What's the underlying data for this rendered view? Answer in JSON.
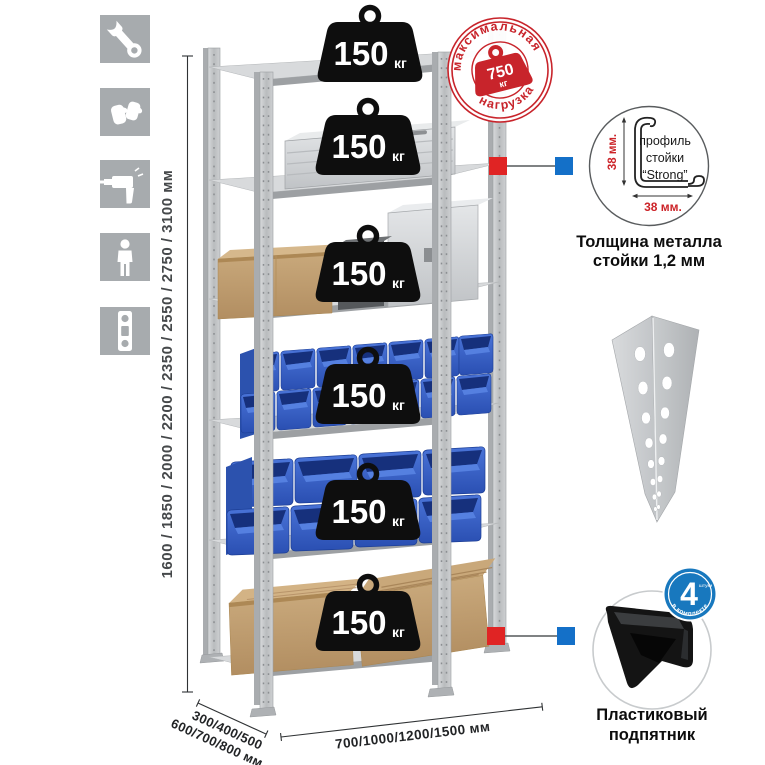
{
  "sidebar": {
    "icons": [
      {
        "name": "wrench"
      },
      {
        "name": "gloves"
      },
      {
        "name": "drill"
      },
      {
        "name": "person"
      },
      {
        "name": "level"
      }
    ]
  },
  "dimensions": {
    "height_label": "1600 / 1850 / 2000 / 2200 / 2350 / 2550 / 2750 / 3100 мм",
    "depth_line1": "300/400/500",
    "depth_line2": "600/700/800 мм",
    "width_label": "700/1000/1200/1500 мм"
  },
  "rack": {
    "shelf_count": 6,
    "shelf_load_value": "150",
    "shelf_load_unit": "кг"
  },
  "stamp": {
    "arc_top": "максимальная",
    "arc_bottom": "нагрузка",
    "value": "750",
    "unit": "кг",
    "color": "#c8242b"
  },
  "profile": {
    "line1": "профиль",
    "line2": "стойки",
    "line3": "“Strong”",
    "dim_v": "38 мм.",
    "dim_h": "38 мм.",
    "caption1": "Толщина металла",
    "caption2": "стойки 1,2 мм"
  },
  "foot": {
    "badge_value": "4",
    "badge_small": "штуки",
    "badge_arc": "в комплекте",
    "badge_color": "#1878be",
    "caption1": "Пластиковый",
    "caption2": "подпятник"
  },
  "colors": {
    "icon_tile": "#a7abae",
    "connector_red": "#e02424",
    "connector_blue": "#1470c8",
    "bin_blue": "#3560c4",
    "metal": "#c9cbcd"
  }
}
